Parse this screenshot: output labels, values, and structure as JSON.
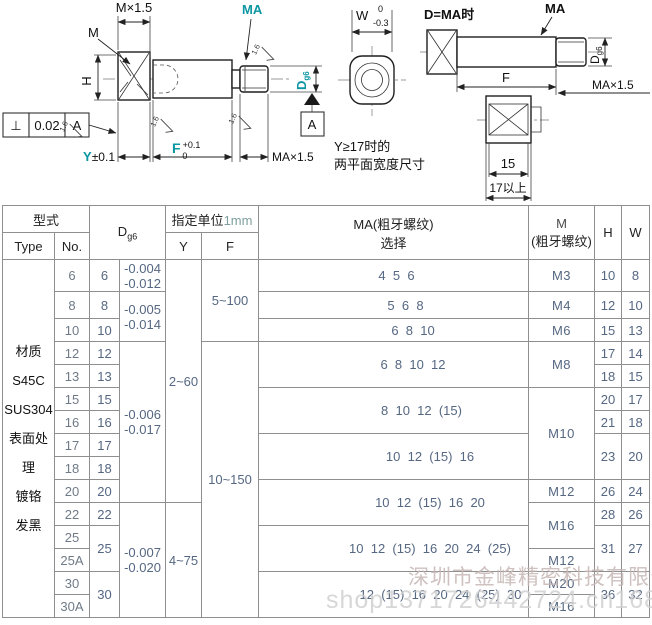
{
  "drawing": {
    "left": {
      "dim_m_thread": "M×1.5",
      "label_m": "M",
      "label_ma": "MA",
      "label_h": "H",
      "label_d": "D",
      "label_d_sub": "g6",
      "fcf_symbol": "⊥",
      "fcf_value": "0.02",
      "fcf_datum": "A",
      "datum_label": "A",
      "dim_y": "Y",
      "dim_y_tol": "±0.1",
      "dim_f": "F",
      "dim_f_tol_up": "+0.1",
      "dim_f_tol_dn": "0",
      "dim_ma_thread": "MA×1.5",
      "roughness": "1.6"
    },
    "right": {
      "dim_w": "W",
      "dim_w_up": "0",
      "dim_w_dn": "-0.3",
      "title": "D=MA时",
      "label_ma": "MA",
      "label_d": "D",
      "label_d_sub": "g6",
      "dim_f": "F",
      "dim_ma_thread": "MA×1.5",
      "note1": "Y≥17时的",
      "note2": "两平面宽度尺寸",
      "dim_15": "15",
      "dim_17": "17以上"
    }
  },
  "table": {
    "header": {
      "model": "型式",
      "type": "Type",
      "no": "No.",
      "d": "D",
      "d_sub": "g6",
      "unit_prefix": "指定单位",
      "unit_value": "1mm",
      "y": "Y",
      "f": "F",
      "ma_line1": "MA(粗牙螺纹)",
      "ma_line2": "选择",
      "m_line1": "M",
      "m_line2": "(粗牙螺纹)",
      "h": "H",
      "w": "W"
    },
    "type_cell_lines": [
      "材质",
      "S45C",
      "SUS304",
      "表面处理",
      "镀铬",
      "发黑"
    ],
    "row_nos": [
      "6",
      "8",
      "10",
      "12",
      "13",
      "15",
      "16",
      "17",
      "18",
      "20",
      "22",
      "25",
      "25A",
      "30",
      "30A"
    ],
    "columns": {
      "d": [
        {
          "text": "6",
          "span": 1
        },
        {
          "text": "8",
          "span": 1
        },
        {
          "text": "10",
          "span": 1
        },
        {
          "text": "12",
          "span": 1
        },
        {
          "text": "13",
          "span": 1
        },
        {
          "text": "15",
          "span": 1
        },
        {
          "text": "16",
          "span": 1
        },
        {
          "text": "17",
          "span": 1
        },
        {
          "text": "18",
          "span": 1
        },
        {
          "text": "20",
          "span": 1
        },
        {
          "text": "22",
          "span": 1
        },
        {
          "text": "25",
          "span": 2
        },
        {
          "text": "30",
          "span": 2
        }
      ],
      "tol": [
        {
          "lines": [
            "-0.004",
            "-0.012"
          ],
          "span": 1
        },
        {
          "lines": [
            "-0.005",
            "-0.014"
          ],
          "span": 2
        },
        {
          "lines": [
            "-0.006",
            "-0.017"
          ],
          "span": 7
        },
        {
          "lines": [
            "-0.007",
            "-0.020"
          ],
          "span": 5
        }
      ],
      "y": [
        {
          "text": "2~60",
          "span": 10
        },
        {
          "text": "4~75",
          "span": 5
        }
      ],
      "f": [
        {
          "text": "5~100",
          "span": 3
        },
        {
          "text": "10~150",
          "span": 12
        }
      ],
      "ma": [
        {
          "text": "4  5  6",
          "span": 1,
          "indent": 6
        },
        {
          "text": "5  6  8",
          "span": 1,
          "indent": 24
        },
        {
          "text": "6  8  10",
          "span": 1,
          "indent": 39
        },
        {
          "text": "6  8  10  12",
          "span": 2,
          "indent": 39
        },
        {
          "text": "8  10  12  (15)",
          "span": 2,
          "indent": 56
        },
        {
          "text": "10  12  (15)  16",
          "span": 2,
          "indent": 73
        },
        {
          "text": "10  12  (15)  16  20",
          "span": 2,
          "indent": 73
        },
        {
          "text": "10  12  (15)  16  20  24  (25)",
          "span": 2,
          "indent": 73
        },
        {
          "text": "12  (15)  16  20  24  (25)  30",
          "span": 2,
          "indent": 94
        }
      ],
      "m": [
        {
          "text": "M3",
          "span": 1
        },
        {
          "text": "M4",
          "span": 1
        },
        {
          "text": "M6",
          "span": 1
        },
        {
          "text": "M8",
          "span": 2
        },
        {
          "text": "M10",
          "span": 4
        },
        {
          "text": "M12",
          "span": 1
        },
        {
          "text": "M16",
          "span": 2
        },
        {
          "text": "M12",
          "span": 1
        },
        {
          "text": "M20",
          "span": 1
        },
        {
          "text": "M16",
          "span": 1
        }
      ],
      "h": [
        {
          "text": "10",
          "span": 1
        },
        {
          "text": "12",
          "span": 1
        },
        {
          "text": "15",
          "span": 1
        },
        {
          "text": "17",
          "span": 1
        },
        {
          "text": "18",
          "span": 1
        },
        {
          "text": "20",
          "span": 1
        },
        {
          "text": "21",
          "span": 1
        },
        {
          "text": "23",
          "span": 2
        },
        {
          "text": "26",
          "span": 1
        },
        {
          "text": "28",
          "span": 1
        },
        {
          "text": "31",
          "span": 2
        },
        {
          "text": "36",
          "span": 2
        }
      ],
      "w": [
        {
          "text": "8",
          "span": 1
        },
        {
          "text": "10",
          "span": 1
        },
        {
          "text": "13",
          "span": 1
        },
        {
          "text": "14",
          "span": 1
        },
        {
          "text": "15",
          "span": 1
        },
        {
          "text": "17",
          "span": 1
        },
        {
          "text": "18",
          "span": 1
        },
        {
          "text": "20",
          "span": 2
        },
        {
          "text": "24",
          "span": 1
        },
        {
          "text": "26",
          "span": 1
        },
        {
          "text": "27",
          "span": 2
        },
        {
          "text": "32",
          "span": 2
        }
      ]
    }
  },
  "watermark": {
    "company": "深圳市金峰精密科技有限公司",
    "shop_url": "shop1371726442724.cn1688.com"
  },
  "colors": {
    "accent_teal": "#0b96a2",
    "table_number": "#556782",
    "line": "#222222"
  }
}
